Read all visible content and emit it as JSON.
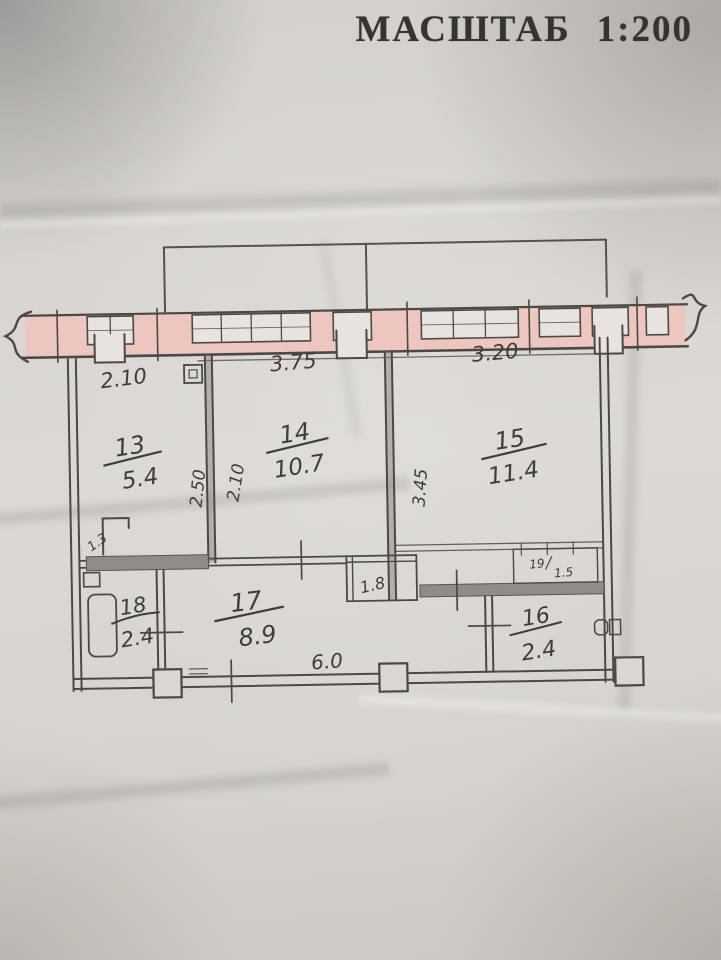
{
  "title": {
    "word": "МАСШТАБ",
    "scale": "1:200"
  },
  "rooms": {
    "r13": {
      "number": "13",
      "area": "5.4"
    },
    "r14": {
      "number": "14",
      "area": "10.7"
    },
    "r15": {
      "number": "15",
      "area": "11.4"
    },
    "r16": {
      "number": "16",
      "area": "2.4"
    },
    "r17": {
      "number": "17",
      "area": "8.9"
    },
    "r18": {
      "number": "18",
      "area": "2.4"
    },
    "r19": {
      "number": "19",
      "area": "1.5"
    }
  },
  "dimensions": {
    "room13_width": "2.10",
    "room14_width": "3.75",
    "room15_width": "3.20",
    "room13_depth_left": "2.50",
    "room13_depth_right": "2.10",
    "room15_depth": "3.45",
    "bottom_length": "6.0"
  },
  "annotations": {
    "closet_area": "1.8",
    "door_note": "1.3"
  },
  "colors": {
    "paper": "#d8d5d0",
    "ink": "#4b4845",
    "wall_fill_pink": "#eec6c0",
    "window_fill": "#e7e4e0",
    "wall_fill_gray": "#8f8c88",
    "handwriting": "#3f3d3a",
    "title_text": "#36342f"
  }
}
